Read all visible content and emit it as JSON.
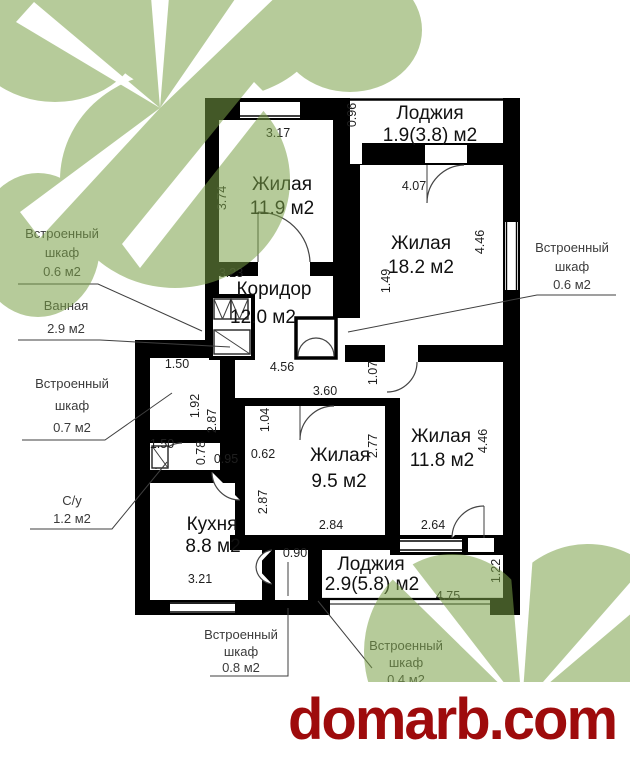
{
  "plan": {
    "rooms": [
      {
        "name": "Жилая",
        "area": "11.9 м2"
      },
      {
        "name": "Лоджия",
        "area": "1.9(3.8) м2"
      },
      {
        "name": "Жилая",
        "area": "18.2 м2"
      },
      {
        "name": "Коридор",
        "area": "12.0 м2"
      },
      {
        "name": "Жилая",
        "area": "9.5 м2"
      },
      {
        "name": "Жилая",
        "area": "11.8 м2"
      },
      {
        "name": "Кухня",
        "area": "8.8 м2"
      },
      {
        "name": "Лоджия",
        "area": "2.9(5.8) м2"
      }
    ],
    "dims": [
      "3.17",
      "3.74",
      "0.96",
      "4.07",
      "4.46",
      "3.23",
      "1.49",
      "4.56",
      "1.07",
      "3.60",
      "2.77",
      "2.84",
      "2.64",
      "4.46",
      "1.50",
      "1.92",
      "2.87",
      "1.04",
      "1.50",
      "0.78",
      "0.95",
      "0.62",
      "2.87",
      "3.21",
      "0.90",
      "4.75",
      "1.22"
    ],
    "outside_labels": [
      {
        "lines": [
          "Встроенный",
          "шкаф",
          "0.6 м2"
        ]
      },
      {
        "lines": [
          "Ванная",
          "2.9 м2",
          ""
        ]
      },
      {
        "lines": [
          "Встроенный",
          "шкаф",
          "0.7 м2"
        ]
      },
      {
        "lines": [
          "С/у",
          "1.2 м2",
          ""
        ]
      },
      {
        "lines": [
          "Встроенный",
          "шкаф",
          "0.6 м2"
        ]
      },
      {
        "lines": [
          "Встроенный",
          "шкаф",
          "0.8 м2"
        ]
      },
      {
        "lines": [
          "Встроенный",
          "шкаф",
          "0.4 м2"
        ]
      }
    ]
  },
  "watermark": {
    "text": "domarb.com",
    "color": "#9e0b0c"
  },
  "colors": {
    "wall": "#000000",
    "leaf": "#7aa148",
    "dim_text": "#1f1f1f",
    "label_text": "#3b3b3b"
  }
}
